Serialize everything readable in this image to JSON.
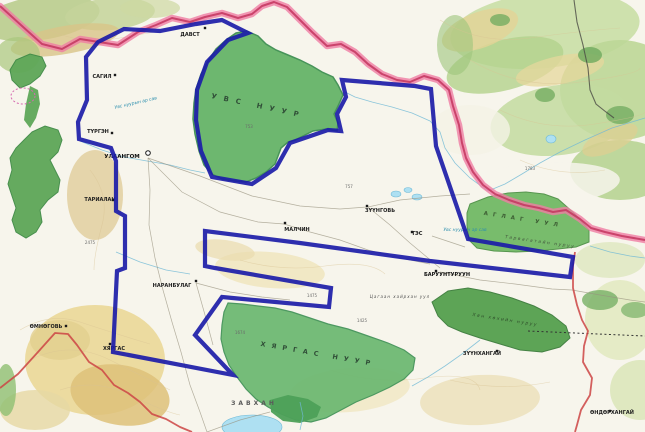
{
  "map": {
    "width": 645,
    "height": 432,
    "background": "#f7f5ec",
    "colors": {
      "boundary_blue": "#1c1ca8",
      "border_pink_band": "#ef7da4",
      "border_pink_core": "#c3355e",
      "aimag_red": "#cc4444",
      "water_fill": "#aee0f2",
      "water_stroke": "#6fb9d6",
      "contour": "#d8c294",
      "road": "#97927d",
      "dark_road": "#4a4a44"
    },
    "blue_boundary": {
      "name": "protected-area-boundary",
      "points": "222,20 196,24 160,31 124,29 98,42 86,57 87,100 78,122 79,139 111,148 116,161 116,211 125,216 125,268 117,271 113,352 233,375 195,335 222,297 329,307 331,288 215,268 205,266 205,231 300,243 430,261 570,277 573,257 468,239 436,146 431,89 415,86 342,80 346,97 337,114 341,131 328,130 290,143 276,168 252,184 212,177 201,151 196,120 197,90 207,62 228,40 248,33"
    },
    "state_border": {
      "name": "state-border-russia-mongolia",
      "points": "0,6 22,26 42,44 62,49 80,39 99,42 118,45 138,32 156,25 172,18 190,22 205,17 222,13 238,18 252,14 262,6 274,2 287,7 298,18 312,32 327,46 341,44 355,52 368,64 382,74 397,80 410,82 424,76 438,80 449,90 453,106 459,125 462,143 466,158 473,172 483,185 495,194 509,200 524,205 539,208 553,212 566,210 580,219 591,228 605,232 622,236 645,240"
    },
    "red_lines": [
      {
        "name": "aimag-border-southwest",
        "points": "0,388 18,374 38,352 55,333 68,334 77,345 89,362 102,370 114,385 128,393 140,402 152,414 166,419 180,427 192,432"
      },
      {
        "name": "aimag-border-southeast",
        "points": "575,252 573,266 573,288 577,305 582,320 588,331 584,346 583,362 592,378 590,395 581,410 577,425 575,432"
      }
    ],
    "green_areas": [
      {
        "name": "lake-uvs-nuur",
        "fill": "#66b469",
        "stroke": "#3e8f52",
        "sw": 1.5,
        "points": "247,31 258,36 266,44 276,50 288,55 300,60 312,66 322,72 333,77 338,85 343,95 338,106 334,114 338,123 337,131 326,129 313,131 303,136 295,140 288,142 281,148 275,164 266,172 256,178 246,182 234,181 222,179 212,174 204,165 199,151 195,134 193,119 194,103 196,89 201,74 208,61 216,49 226,40 236,33"
      },
      {
        "name": "lake-khyargas-nuur",
        "fill": "#6fb973",
        "stroke": "#44945a",
        "sw": 1.2,
        "points": "228,303 242,304 258,306 275,308 292,312 310,318 328,324 348,329 368,336 388,343 404,350 415,358 413,370 404,379 390,387 373,395 356,402 341,410 326,418 311,422 296,420 281,414 268,407 256,399 246,389 237,377 229,365 224,352 221,339 222,325 224,312"
      },
      {
        "name": "lake-khyargas-inner",
        "fill": "#4da058",
        "stroke": "none",
        "sw": 0,
        "points": "270,400 288,395 308,399 321,407 317,417 300,423 283,421 271,412"
      },
      {
        "name": "green-block-aglag-uul",
        "fill": "#72ba66",
        "stroke": "#4f9147",
        "sw": 1,
        "points": "470,204 488,197 508,193 526,192 544,194 558,199 566,206 575,214 589,230 589,242 576,247 558,249 538,251 516,252 494,251 477,248 469,240 467,226 467,213"
      },
      {
        "name": "forest-khan-khokhii",
        "fill": "#55a04f",
        "stroke": "#3c7c3c",
        "sw": 1,
        "points": "432,302 448,291 468,288 490,292 512,298 534,306 552,315 566,326 570,338 560,347 542,352 520,350 500,344 480,338 462,332 448,326 438,316"
      },
      {
        "name": "green-west-upper",
        "fill": "#5ea758",
        "stroke": "#3f8a46",
        "sw": 1,
        "points": "16,60 30,54 42,57 46,66 40,76 30,84 20,88 12,80 10,70"
      },
      {
        "name": "green-west-bridge",
        "fill": "#5ea758",
        "stroke": "none",
        "sw": 0,
        "points": "30,86 38,90 40,104 36,118 30,128 24,120 26,104"
      },
      {
        "name": "green-west-lower",
        "fill": "#5ea758",
        "stroke": "#3f8a46",
        "sw": 1,
        "points": "32,132 45,126 58,130 62,140 58,152 50,160 55,170 60,180 58,192 48,200 40,210 42,222 36,232 26,238 16,232 12,220 16,208 12,196 8,184 12,170 10,158 16,148 24,140"
      }
    ],
    "terrain": [
      {
        "cx": 40,
        "cy": 18,
        "rx": 60,
        "ry": 22,
        "f": "#b9cd8e",
        "o": 0.9,
        "r": -8
      },
      {
        "cx": 110,
        "cy": 14,
        "rx": 45,
        "ry": 16,
        "f": "#c4d49a",
        "o": 0.85,
        "r": -5
      },
      {
        "cx": 65,
        "cy": 40,
        "rx": 55,
        "ry": 14,
        "f": "#d8c488",
        "o": 0.8,
        "r": -10
      },
      {
        "cx": 18,
        "cy": 55,
        "rx": 22,
        "ry": 18,
        "f": "#a9c87e",
        "o": 0.7,
        "r": 0
      },
      {
        "cx": 150,
        "cy": 8,
        "rx": 30,
        "ry": 10,
        "f": "#cdd9a2",
        "o": 0.7,
        "r": 0
      },
      {
        "cx": 545,
        "cy": 30,
        "rx": 95,
        "ry": 38,
        "f": "#c9dfa6",
        "o": 0.9,
        "r": -6
      },
      {
        "cx": 620,
        "cy": 90,
        "rx": 60,
        "ry": 50,
        "f": "#bcd797",
        "o": 0.9,
        "r": 0
      },
      {
        "cx": 505,
        "cy": 65,
        "rx": 60,
        "ry": 25,
        "f": "#b3d28c",
        "o": 0.8,
        "r": -15
      },
      {
        "cx": 560,
        "cy": 120,
        "rx": 70,
        "ry": 35,
        "f": "#c3dba0",
        "o": 0.85,
        "r": -8
      },
      {
        "cx": 620,
        "cy": 170,
        "rx": 50,
        "ry": 30,
        "f": "#afcf88",
        "o": 0.8,
        "r": 0
      },
      {
        "cx": 480,
        "cy": 30,
        "rx": 40,
        "ry": 18,
        "f": "#e3d396",
        "o": 0.8,
        "r": -20
      },
      {
        "cx": 560,
        "cy": 70,
        "rx": 45,
        "ry": 14,
        "f": "#e6d79c",
        "o": 0.75,
        "r": -12
      },
      {
        "cx": 610,
        "cy": 140,
        "rx": 30,
        "ry": 12,
        "f": "#e0cf92",
        "o": 0.7,
        "r": -25
      },
      {
        "cx": 455,
        "cy": 45,
        "rx": 18,
        "ry": 30,
        "f": "#9cc47c",
        "o": 0.6,
        "r": 0
      },
      {
        "cx": 590,
        "cy": 55,
        "rx": 12,
        "ry": 8,
        "f": "#74ad62",
        "o": 0.85,
        "r": 0
      },
      {
        "cx": 545,
        "cy": 95,
        "rx": 10,
        "ry": 7,
        "f": "#74ad62",
        "o": 0.8,
        "r": 0
      },
      {
        "cx": 620,
        "cy": 115,
        "rx": 14,
        "ry": 9,
        "f": "#74ad62",
        "o": 0.8,
        "r": 0
      },
      {
        "cx": 500,
        "cy": 20,
        "rx": 10,
        "ry": 6,
        "f": "#74ad62",
        "o": 0.8,
        "r": 0
      },
      {
        "cx": 540,
        "cy": 185,
        "rx": 80,
        "ry": 22,
        "f": "#f7f5ec",
        "o": 0.85,
        "r": -4
      },
      {
        "cx": 470,
        "cy": 130,
        "rx": 40,
        "ry": 25,
        "f": "#f4f2e6",
        "o": 0.8,
        "r": 0
      },
      {
        "cx": 95,
        "cy": 360,
        "rx": 70,
        "ry": 55,
        "f": "#ead898",
        "o": 0.9,
        "r": 0
      },
      {
        "cx": 120,
        "cy": 395,
        "rx": 50,
        "ry": 30,
        "f": "#dec179",
        "o": 0.85,
        "r": 10
      },
      {
        "cx": 60,
        "cy": 340,
        "rx": 30,
        "ry": 20,
        "f": "#e2cf8e",
        "o": 0.8,
        "r": 0
      },
      {
        "cx": 35,
        "cy": 410,
        "rx": 35,
        "ry": 20,
        "f": "#e6d8a4",
        "o": 0.8,
        "r": 0
      },
      {
        "cx": 6,
        "cy": 390,
        "rx": 10,
        "ry": 26,
        "f": "#8fbf72",
        "o": 0.8,
        "r": 0
      },
      {
        "cx": 270,
        "cy": 270,
        "rx": 55,
        "ry": 18,
        "f": "#efe5bc",
        "o": 0.8,
        "r": 5
      },
      {
        "cx": 225,
        "cy": 250,
        "rx": 30,
        "ry": 10,
        "f": "#e9dcae",
        "o": 0.7,
        "r": 8
      },
      {
        "cx": 95,
        "cy": 195,
        "rx": 28,
        "ry": 45,
        "f": "#dfca96",
        "o": 0.75,
        "r": 0
      },
      {
        "cx": 350,
        "cy": 390,
        "rx": 60,
        "ry": 22,
        "f": "#eee2b6",
        "o": 0.6,
        "r": -5
      },
      {
        "cx": 480,
        "cy": 400,
        "rx": 60,
        "ry": 25,
        "f": "#e8d9a8",
        "o": 0.6,
        "r": -3
      },
      {
        "cx": 620,
        "cy": 320,
        "rx": 35,
        "ry": 40,
        "f": "#d9e4ae",
        "o": 0.6,
        "r": 0
      },
      {
        "cx": 640,
        "cy": 390,
        "rx": 30,
        "ry": 30,
        "f": "#cfe0a4",
        "o": 0.6,
        "r": 0
      },
      {
        "cx": 610,
        "cy": 260,
        "rx": 35,
        "ry": 18,
        "f": "#cfe0a4",
        "o": 0.5,
        "r": 0
      },
      {
        "cx": 600,
        "cy": 300,
        "rx": 18,
        "ry": 10,
        "f": "#77b065",
        "o": 0.8,
        "r": 0
      },
      {
        "cx": 635,
        "cy": 310,
        "rx": 14,
        "ry": 8,
        "f": "#77b065",
        "o": 0.7,
        "r": 0
      }
    ],
    "contours": [
      "M20,330 q30,-18 60,-8 t70,22",
      "M30,360 q40,-20 80,0 t60,30",
      "M60,390 q35,-12 70,5 t50,20",
      "M440,20 q40,25 90,18 t90,-10",
      "M470,60 q50,30 110,22 t60,-14",
      "M500,110 q45,22 95,14 t50,-12",
      "M520,160 q40,18 85,10",
      "M50,30 q30,15 70,8 t60,-10",
      "M240,260 q40,12 85,6 t60,8",
      "M330,370 q45,15 95,8 t55,12",
      "M450,380 q50,12 100,2",
      "M90,170 q20,25 12,55 t-8,45"
    ],
    "rivers": [
      "M645,118 L612,128 585,140 560,152 540,163 522,174 505,184 488,191",
      "M488,191 L470,178 455,163 445,148 440,132 430,121 412,113 392,107 372,102 355,97 345,92",
      "M80,141 L102,150 124,157 147,161 170,165 190,170 205,173",
      "M116,252 L140,262 166,270 190,274",
      "M480,340 L462,354 445,366 428,377 412,386",
      "M590,246 L610,252 630,256 645,258",
      "M300,430 L303,416 300,402"
    ],
    "roads": [
      "M148,158 L200,176 252,196 300,206 340,209 367,207",
      "M148,158 L150,190 149,225 155,258 163,290 172,322 181,352 190,385 200,412 207,432",
      "M148,158 L182,192 220,212 258,222 284,224",
      "M284,224 L310,232 340,240 368,250 400,258 430,264",
      "M368,207 L390,225 410,243 428,258 440,268",
      "M440,272 L480,280 515,284 552,289 572,290",
      "M196,283 L230,292 262,297 290,300",
      "M196,283 L205,315 213,345",
      "M368,207 L400,200 440,196 470,194",
      "M207,432 L240,420 270,412",
      "M572,290 L600,295 630,300 645,302",
      "M432,236 L450,242 465,247"
    ],
    "dark_road": "M574,0 L577,22 583,45 588,68 590,90 596,104 606,112 614,118",
    "dotted_track": "M528,331 L645,336",
    "small_lakes": [
      {
        "cx": 396,
        "cy": 194,
        "rx": 5,
        "ry": 3
      },
      {
        "cx": 408,
        "cy": 190,
        "rx": 4,
        "ry": 2.5
      },
      {
        "cx": 417,
        "cy": 197,
        "rx": 5,
        "ry": 3
      },
      {
        "cx": 551,
        "cy": 139,
        "rx": 5,
        "ry": 4
      },
      {
        "cx": 252,
        "cy": 427,
        "rx": 30,
        "ry": 12
      }
    ],
    "pink_dashed_area": {
      "cx": 23,
      "cy": 96,
      "rx": 12,
      "ry": 8
    },
    "labels": [
      {
        "t": "УВС НУУР",
        "x": 258,
        "y": 108,
        "s": 7,
        "c": "#314f38",
        "r": 12,
        "ls": 7,
        "w": 600
      },
      {
        "t": "ХЯРГАС НУУР",
        "x": 318,
        "y": 356,
        "s": 6.5,
        "c": "#314f38",
        "r": 10,
        "ls": 6,
        "w": 600
      },
      {
        "t": "АГЛАГ УУЛ",
        "x": 523,
        "y": 221,
        "s": 5.5,
        "c": "#3c5c33",
        "r": 9,
        "ls": 5,
        "w": 600
      },
      {
        "t": "Тарвагатайн нуруу",
        "x": 540,
        "y": 243,
        "s": 4.5,
        "c": "#44583e",
        "r": 8,
        "ls": 1.5,
        "i": 1
      },
      {
        "t": "Хан хөхийн нуруу",
        "x": 505,
        "y": 321,
        "s": 4.5,
        "c": "#2e4d2a",
        "r": 9,
        "ls": 1.5,
        "i": 1
      },
      {
        "t": "ДАВСТ",
        "x": 190,
        "y": 36,
        "s": 5,
        "c": "#1d1d1d",
        "w": 600
      },
      {
        "t": "САГИЛ",
        "x": 102,
        "y": 78,
        "s": 5,
        "c": "#1d1d1d",
        "w": 600
      },
      {
        "t": "ТҮРГЭН",
        "x": 98,
        "y": 133,
        "s": 5,
        "c": "#1d1d1d",
        "w": 600
      },
      {
        "t": "УЛААНГОМ",
        "x": 122,
        "y": 158,
        "s": 5.5,
        "c": "#111111",
        "w": 700
      },
      {
        "t": "ТАРИАЛАН",
        "x": 100,
        "y": 201,
        "s": 5,
        "c": "#1d1d1d",
        "w": 600
      },
      {
        "t": "МАЛЧИН",
        "x": 297,
        "y": 231,
        "s": 5,
        "c": "#1d1d1d",
        "w": 600
      },
      {
        "t": "ЗҮҮНГОВЬ",
        "x": 380,
        "y": 212,
        "s": 5,
        "c": "#1d1d1d",
        "w": 600
      },
      {
        "t": "ТЭС",
        "x": 417,
        "y": 235,
        "s": 5,
        "c": "#1d1d1d",
        "w": 600
      },
      {
        "t": "НАРАНБУЛАГ",
        "x": 172,
        "y": 287,
        "s": 5,
        "c": "#1d1d1d",
        "w": 600
      },
      {
        "t": "БАРУУНТУРУУН",
        "x": 447,
        "y": 276,
        "s": 5,
        "c": "#111111",
        "w": 700
      },
      {
        "t": "ӨМНӨГОВЬ",
        "x": 46,
        "y": 328,
        "s": 5,
        "c": "#1d1d1d",
        "w": 600
      },
      {
        "t": "ХЯРГАС",
        "x": 114,
        "y": 350,
        "s": 5,
        "c": "#1d1d1d",
        "w": 600
      },
      {
        "t": "ЗҮҮНХАНГАЙ",
        "x": 482,
        "y": 355,
        "s": 5,
        "c": "#1d1d1d",
        "w": 600
      },
      {
        "t": "ӨНДӨРХАНГАЙ",
        "x": 612,
        "y": 414,
        "s": 5,
        "c": "#1d1d1d",
        "w": 600
      },
      {
        "t": "Цагаан хайрхан уул",
        "x": 400,
        "y": 298,
        "s": 4,
        "c": "#4a4a4a",
        "i": 1,
        "ls": 1
      },
      {
        "t": "ЗАВХАН",
        "x": 254,
        "y": 405,
        "s": 6,
        "c": "#5a5a5a",
        "ls": 3,
        "w": 600
      },
      {
        "t": "Увс нуурын ар сав",
        "x": 136,
        "y": 104,
        "s": 4.5,
        "c": "#2d8fae",
        "r": -13,
        "i": 1
      },
      {
        "t": "Увс нуурын ар сав",
        "x": 465,
        "y": 231,
        "s": 4.5,
        "c": "#2d8fae",
        "i": 1
      }
    ],
    "spot_heights": [
      {
        "t": "753",
        "x": 249,
        "y": 128
      },
      {
        "t": "757",
        "x": 349,
        "y": 188
      },
      {
        "t": "1475",
        "x": 312,
        "y": 297
      },
      {
        "t": "1674",
        "x": 240,
        "y": 334
      },
      {
        "t": "2475",
        "x": 90,
        "y": 244
      },
      {
        "t": "1783",
        "x": 530,
        "y": 170
      },
      {
        "t": "1425",
        "x": 362,
        "y": 322
      }
    ],
    "markers": [
      {
        "x": 205,
        "y": 28
      },
      {
        "x": 115,
        "y": 75
      },
      {
        "x": 112,
        "y": 133
      },
      {
        "x": 113,
        "y": 200
      },
      {
        "x": 285,
        "y": 223
      },
      {
        "x": 367,
        "y": 206
      },
      {
        "x": 412,
        "y": 232
      },
      {
        "x": 196,
        "y": 281
      },
      {
        "x": 436,
        "y": 271
      },
      {
        "x": 66,
        "y": 326
      },
      {
        "x": 110,
        "y": 344
      },
      {
        "x": 497,
        "y": 351
      },
      {
        "x": 610,
        "y": 411
      }
    ],
    "city_marker": {
      "x": 148,
      "y": 153
    }
  }
}
